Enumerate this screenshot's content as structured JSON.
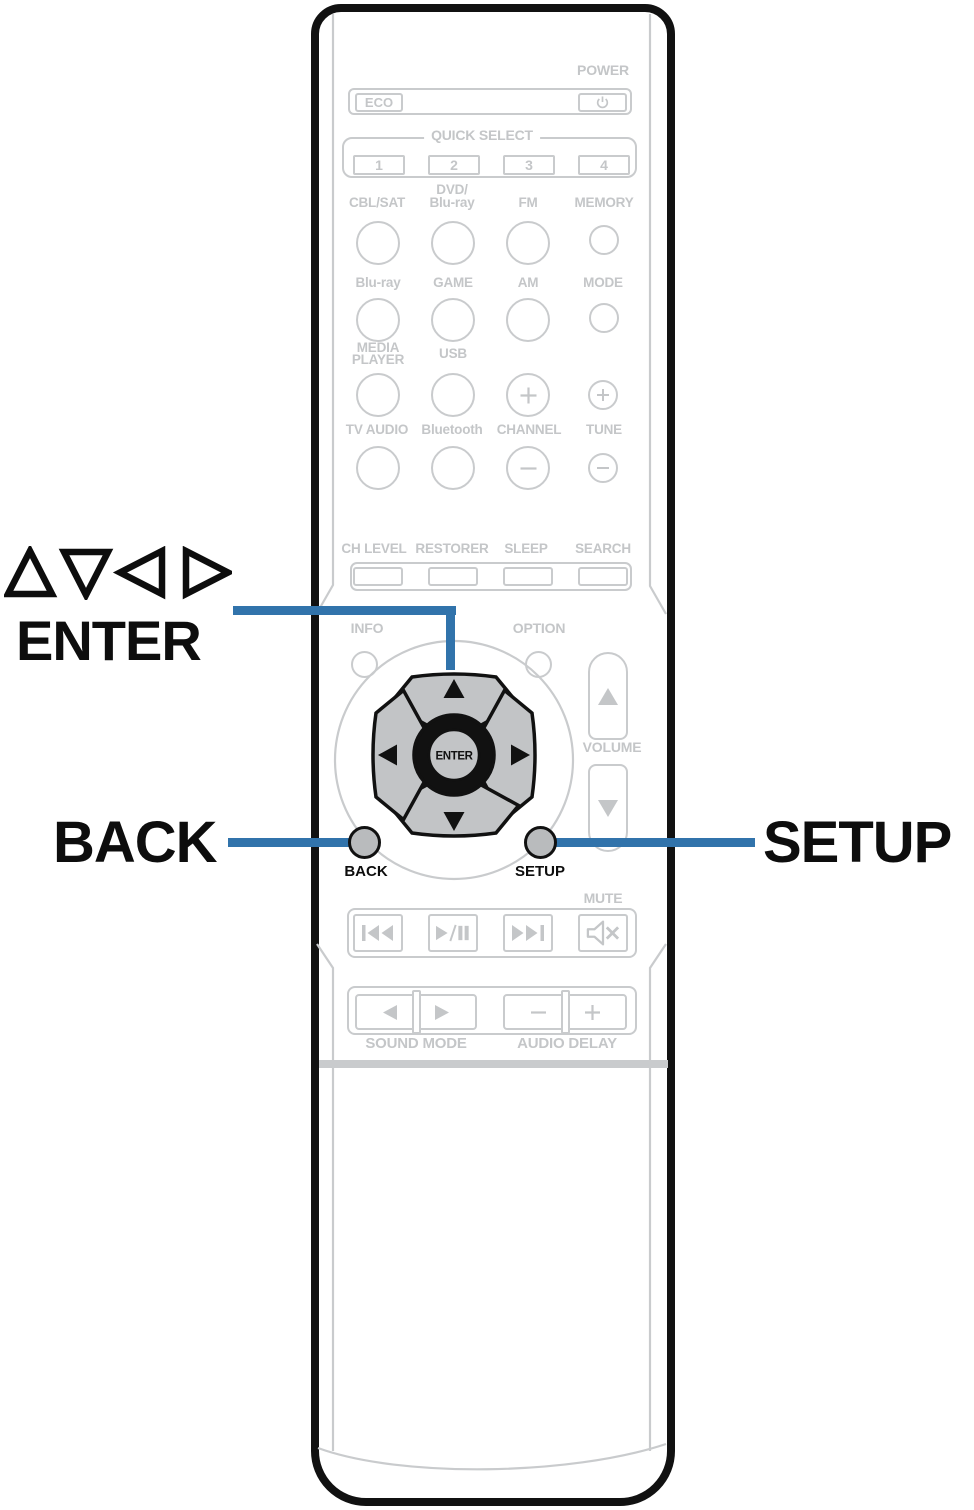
{
  "title": "Remote control unit diagram",
  "colors": {
    "accent_blue": "#3173ab",
    "outline_gray": "#c9cbcd",
    "label_gray": "#c4c6c8",
    "key_gray": "#c2c4c6",
    "highlight_button_gray": "#b9bbbd",
    "body_black": "#111111"
  },
  "callouts": {
    "cursor_symbols": "△▽◁ ▷",
    "enter": "ENTER",
    "back": "BACK",
    "setup": "SETUP"
  },
  "top": {
    "power_label": "POWER",
    "eco_label": "ECO"
  },
  "quick_select": {
    "label": "QUICK SELECT",
    "buttons": [
      "1",
      "2",
      "3",
      "4"
    ]
  },
  "sources": {
    "row1": {
      "cbl_sat": "CBL/SAT",
      "dvd_line1": "DVD/",
      "dvd_line2": "Blu-ray",
      "fm": "FM",
      "memory": "MEMORY"
    },
    "row2": {
      "blu_ray": "Blu-ray",
      "game": "GAME",
      "am": "AM",
      "mode": "MODE"
    },
    "row3": {
      "media_line1": "MEDIA",
      "media_line2": "PLAYER",
      "usb": "USB"
    },
    "row4": {
      "tv_audio": "TV AUDIO",
      "bluetooth": "Bluetooth",
      "channel": "CHANNEL",
      "tune": "TUNE"
    }
  },
  "mid_row": {
    "ch_level": "CH LEVEL",
    "restorer": "RESTORER",
    "sleep": "SLEEP",
    "search": "SEARCH"
  },
  "nav": {
    "info": "INFO",
    "option": "OPTION",
    "volume": "VOLUME",
    "enter": "ENTER",
    "back": "BACK",
    "setup": "SETUP"
  },
  "transport": {
    "mute_label": "MUTE"
  },
  "bottom_row": {
    "sound_mode": "SOUND MODE",
    "audio_delay": "AUDIO DELAY"
  },
  "icons": {
    "power": "⏻",
    "plus": "+",
    "minus": "−",
    "cursor_up": "▲",
    "cursor_down": "▼",
    "cursor_left": "◀",
    "cursor_right": "▶",
    "volume_up": "▲",
    "volume_down": "▼",
    "skip_back": "⏮",
    "play_pause": "▶/❚❚",
    "skip_forward": "⏭",
    "mute": "speaker-x",
    "sound_mode_left": "◀",
    "sound_mode_right": "▶",
    "callout_cursor": "△▽◁▷"
  }
}
